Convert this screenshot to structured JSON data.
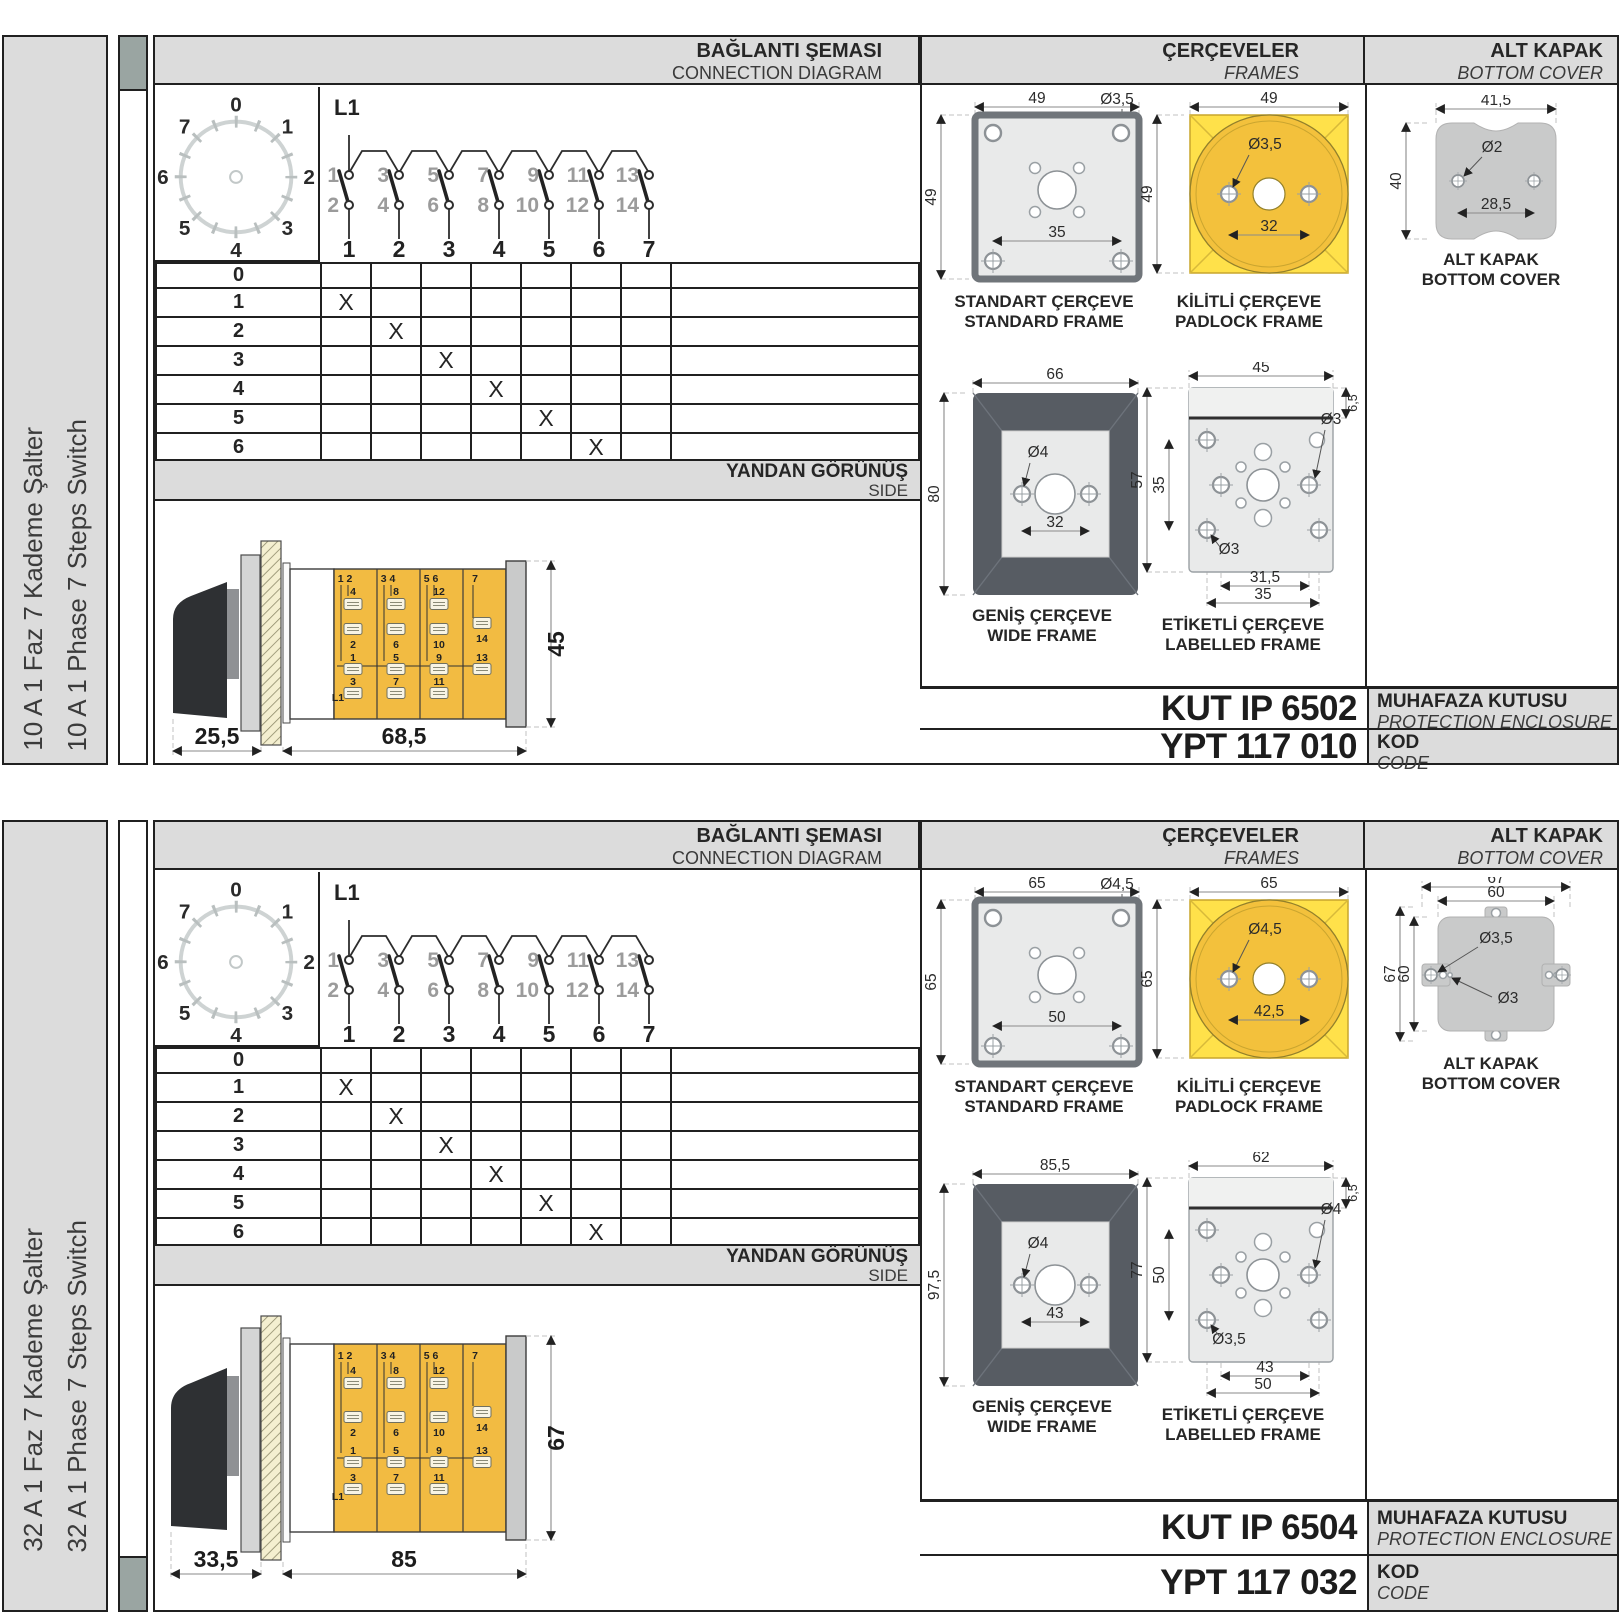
{
  "colors": {
    "header_gray": "#dcdcdc",
    "marker_gray": "#9aa5a2",
    "switch_body_yellow": "#f2bb42",
    "padlock_yellow": "#ffe14a",
    "padlock_circle": "#f3c13c",
    "frame_dark_gray": "#575c63"
  },
  "sections": [
    {
      "side_label_tr": "10 A 1 Faz 7 Kademe Şalter",
      "side_label_en": "10 A 1 Phase 7 Steps Switch",
      "header": {
        "conn_tr": "BAĞLANTI ŞEMASI",
        "conn_en": "CONNECTION DIAGRAM",
        "frames_tr": "ÇERÇEVELER",
        "frames_en": "FRAMES",
        "cover_tr": "ALT KAPAK",
        "cover_en": "BOTTOM COVER"
      },
      "dial": [
        "0",
        "1",
        "2",
        "3",
        "4",
        "5",
        "6",
        "7"
      ],
      "circuit": {
        "phase": "L1",
        "upper": [
          "1",
          "3",
          "5",
          "7",
          "9",
          "11",
          "13"
        ],
        "lower": [
          "2",
          "4",
          "6",
          "8",
          "10",
          "12",
          "14"
        ],
        "outputs": [
          "1",
          "2",
          "3",
          "4",
          "5",
          "6",
          "7"
        ]
      },
      "table": {
        "mark": "X",
        "rows": [
          {
            "label": "0",
            "x_col": 0
          },
          {
            "label": "1",
            "x_col": 1
          },
          {
            "label": "2",
            "x_col": 2
          },
          {
            "label": "3",
            "x_col": 3
          },
          {
            "label": "4",
            "x_col": 4
          },
          {
            "label": "5",
            "x_col": 5
          },
          {
            "label": "6",
            "x_col": 6
          },
          {
            "label": "7",
            "x_col": 7
          }
        ]
      },
      "side_view": {
        "bar_tr": "YANDAN GÖRÜNÜŞ",
        "bar_en": "SIDE",
        "dim_front": "25,5",
        "dim_body": "68,5",
        "dim_height": "45",
        "modules": [
          {
            "top": "1 2",
            "a": "4",
            "b": "2",
            "c": "1",
            "d": "3",
            "feed": "L1"
          },
          {
            "top": "3 4",
            "a": "8",
            "b": "6",
            "c": "5",
            "d": "7"
          },
          {
            "top": "5 6",
            "a": "12",
            "b": "10",
            "c": "9",
            "d": "11"
          },
          {
            "top": "7",
            "b": "14",
            "c": "13"
          }
        ]
      },
      "frames_panel": {
        "standard": {
          "cap_tr": "STANDART ÇERÇEVE",
          "cap_en": "STANDARD FRAME",
          "w": "49",
          "h": "49",
          "hole": "Ø3,5",
          "pitch": "35"
        },
        "padlock": {
          "cap_tr": "KİLİTLİ ÇERÇEVE",
          "cap_en": "PADLOCK FRAME",
          "w": "49",
          "h": "49",
          "hole": "Ø3,5",
          "pitch": "32"
        },
        "wide": {
          "cap_tr": "GENİŞ ÇERÇEVE",
          "cap_en": "WIDE FRAME",
          "w": "66",
          "h": "80",
          "hole": "Ø4",
          "pitch": "32"
        },
        "labelled": {
          "cap_tr": "ETİKETLİ ÇERÇEVE",
          "cap_en": "LABELLED FRAME",
          "w": "45",
          "h": "57",
          "pitch_v": "35",
          "hole_r": "Ø3",
          "hole_l": "Ø3",
          "pitch1": "31,5",
          "pitch2": "35",
          "strip": "6,5"
        }
      },
      "cover_panel": {
        "cap_tr": "ALT KAPAK",
        "cap_en": "BOTTOM COVER",
        "w": "41,5",
        "h": "40",
        "hole": "Ø2",
        "pitch": "28,5"
      },
      "codes": {
        "enclosure": "KUT IP 6502",
        "enclosure_tr": "MUHAFAZA KUTUSU",
        "enclosure_en": "PROTECTION ENCLOSURE",
        "code": "YPT 117 010",
        "code_tr": "KOD",
        "code_en": "CODE"
      }
    },
    {
      "side_label_tr": "32 A 1 Faz 7 Kademe Şalter",
      "side_label_en": "32 A 1 Phase 7 Steps Switch",
      "header": {
        "conn_tr": "BAĞLANTI ŞEMASI",
        "conn_en": "CONNECTION DIAGRAM",
        "frames_tr": "ÇERÇEVELER",
        "frames_en": "FRAMES",
        "cover_tr": "ALT KAPAK",
        "cover_en": "BOTTOM COVER"
      },
      "dial": [
        "0",
        "1",
        "2",
        "3",
        "4",
        "5",
        "6",
        "7"
      ],
      "circuit": {
        "phase": "L1",
        "upper": [
          "1",
          "3",
          "5",
          "7",
          "9",
          "11",
          "13"
        ],
        "lower": [
          "2",
          "4",
          "6",
          "8",
          "10",
          "12",
          "14"
        ],
        "outputs": [
          "1",
          "2",
          "3",
          "4",
          "5",
          "6",
          "7"
        ]
      },
      "table": {
        "mark": "X",
        "rows": [
          {
            "label": "0",
            "x_col": 0
          },
          {
            "label": "1",
            "x_col": 1
          },
          {
            "label": "2",
            "x_col": 2
          },
          {
            "label": "3",
            "x_col": 3
          },
          {
            "label": "4",
            "x_col": 4
          },
          {
            "label": "5",
            "x_col": 5
          },
          {
            "label": "6",
            "x_col": 6
          },
          {
            "label": "7",
            "x_col": 7
          }
        ]
      },
      "side_view": {
        "bar_tr": "YANDAN GÖRÜNÜŞ",
        "bar_en": "SIDE",
        "dim_front": "33,5",
        "dim_body": "85",
        "dim_height": "67",
        "modules": [
          {
            "top": "1 2",
            "a": "4",
            "b": "2",
            "c": "1",
            "d": "3",
            "feed": "L1"
          },
          {
            "top": "3 4",
            "a": "8",
            "b": "6",
            "c": "5",
            "d": "7"
          },
          {
            "top": "5 6",
            "a": "12",
            "b": "10",
            "c": "9",
            "d": "11"
          },
          {
            "top": "7",
            "b": "14",
            "c": "13"
          }
        ]
      },
      "frames_panel": {
        "standard": {
          "cap_tr": "STANDART ÇERÇEVE",
          "cap_en": "STANDARD FRAME",
          "w": "65",
          "h": "65",
          "hole": "Ø4,5",
          "pitch": "50"
        },
        "padlock": {
          "cap_tr": "KİLİTLİ ÇERÇEVE",
          "cap_en": "PADLOCK FRAME",
          "w": "65",
          "h": "65",
          "hole": "Ø4,5",
          "pitch": "42,5"
        },
        "wide": {
          "cap_tr": "GENİŞ ÇERÇEVE",
          "cap_en": "WIDE FRAME",
          "w": "85,5",
          "h": "97,5",
          "hole": "Ø4",
          "pitch": "43"
        },
        "labelled": {
          "cap_tr": "ETİKETLİ ÇERÇEVE",
          "cap_en": "LABELLED FRAME",
          "w": "62",
          "h": "77",
          "pitch_v": "50",
          "hole_r": "Ø4",
          "hole_l": "Ø3,5",
          "pitch1": "43",
          "pitch2": "50",
          "strip": "6,5"
        }
      },
      "cover_panel": {
        "cap_tr": "ALT KAPAK",
        "cap_en": "BOTTOM COVER",
        "w1": "67",
        "w2": "60",
        "h1": "67",
        "h2": "60",
        "hole1": "Ø3,5",
        "hole2": "Ø3"
      },
      "codes": {
        "enclosure": "KUT IP 6504",
        "enclosure_tr": "MUHAFAZA KUTUSU",
        "enclosure_en": "PROTECTION ENCLOSURE",
        "code": "YPT 117 032",
        "code_tr": "KOD",
        "code_en": "CODE"
      }
    }
  ]
}
